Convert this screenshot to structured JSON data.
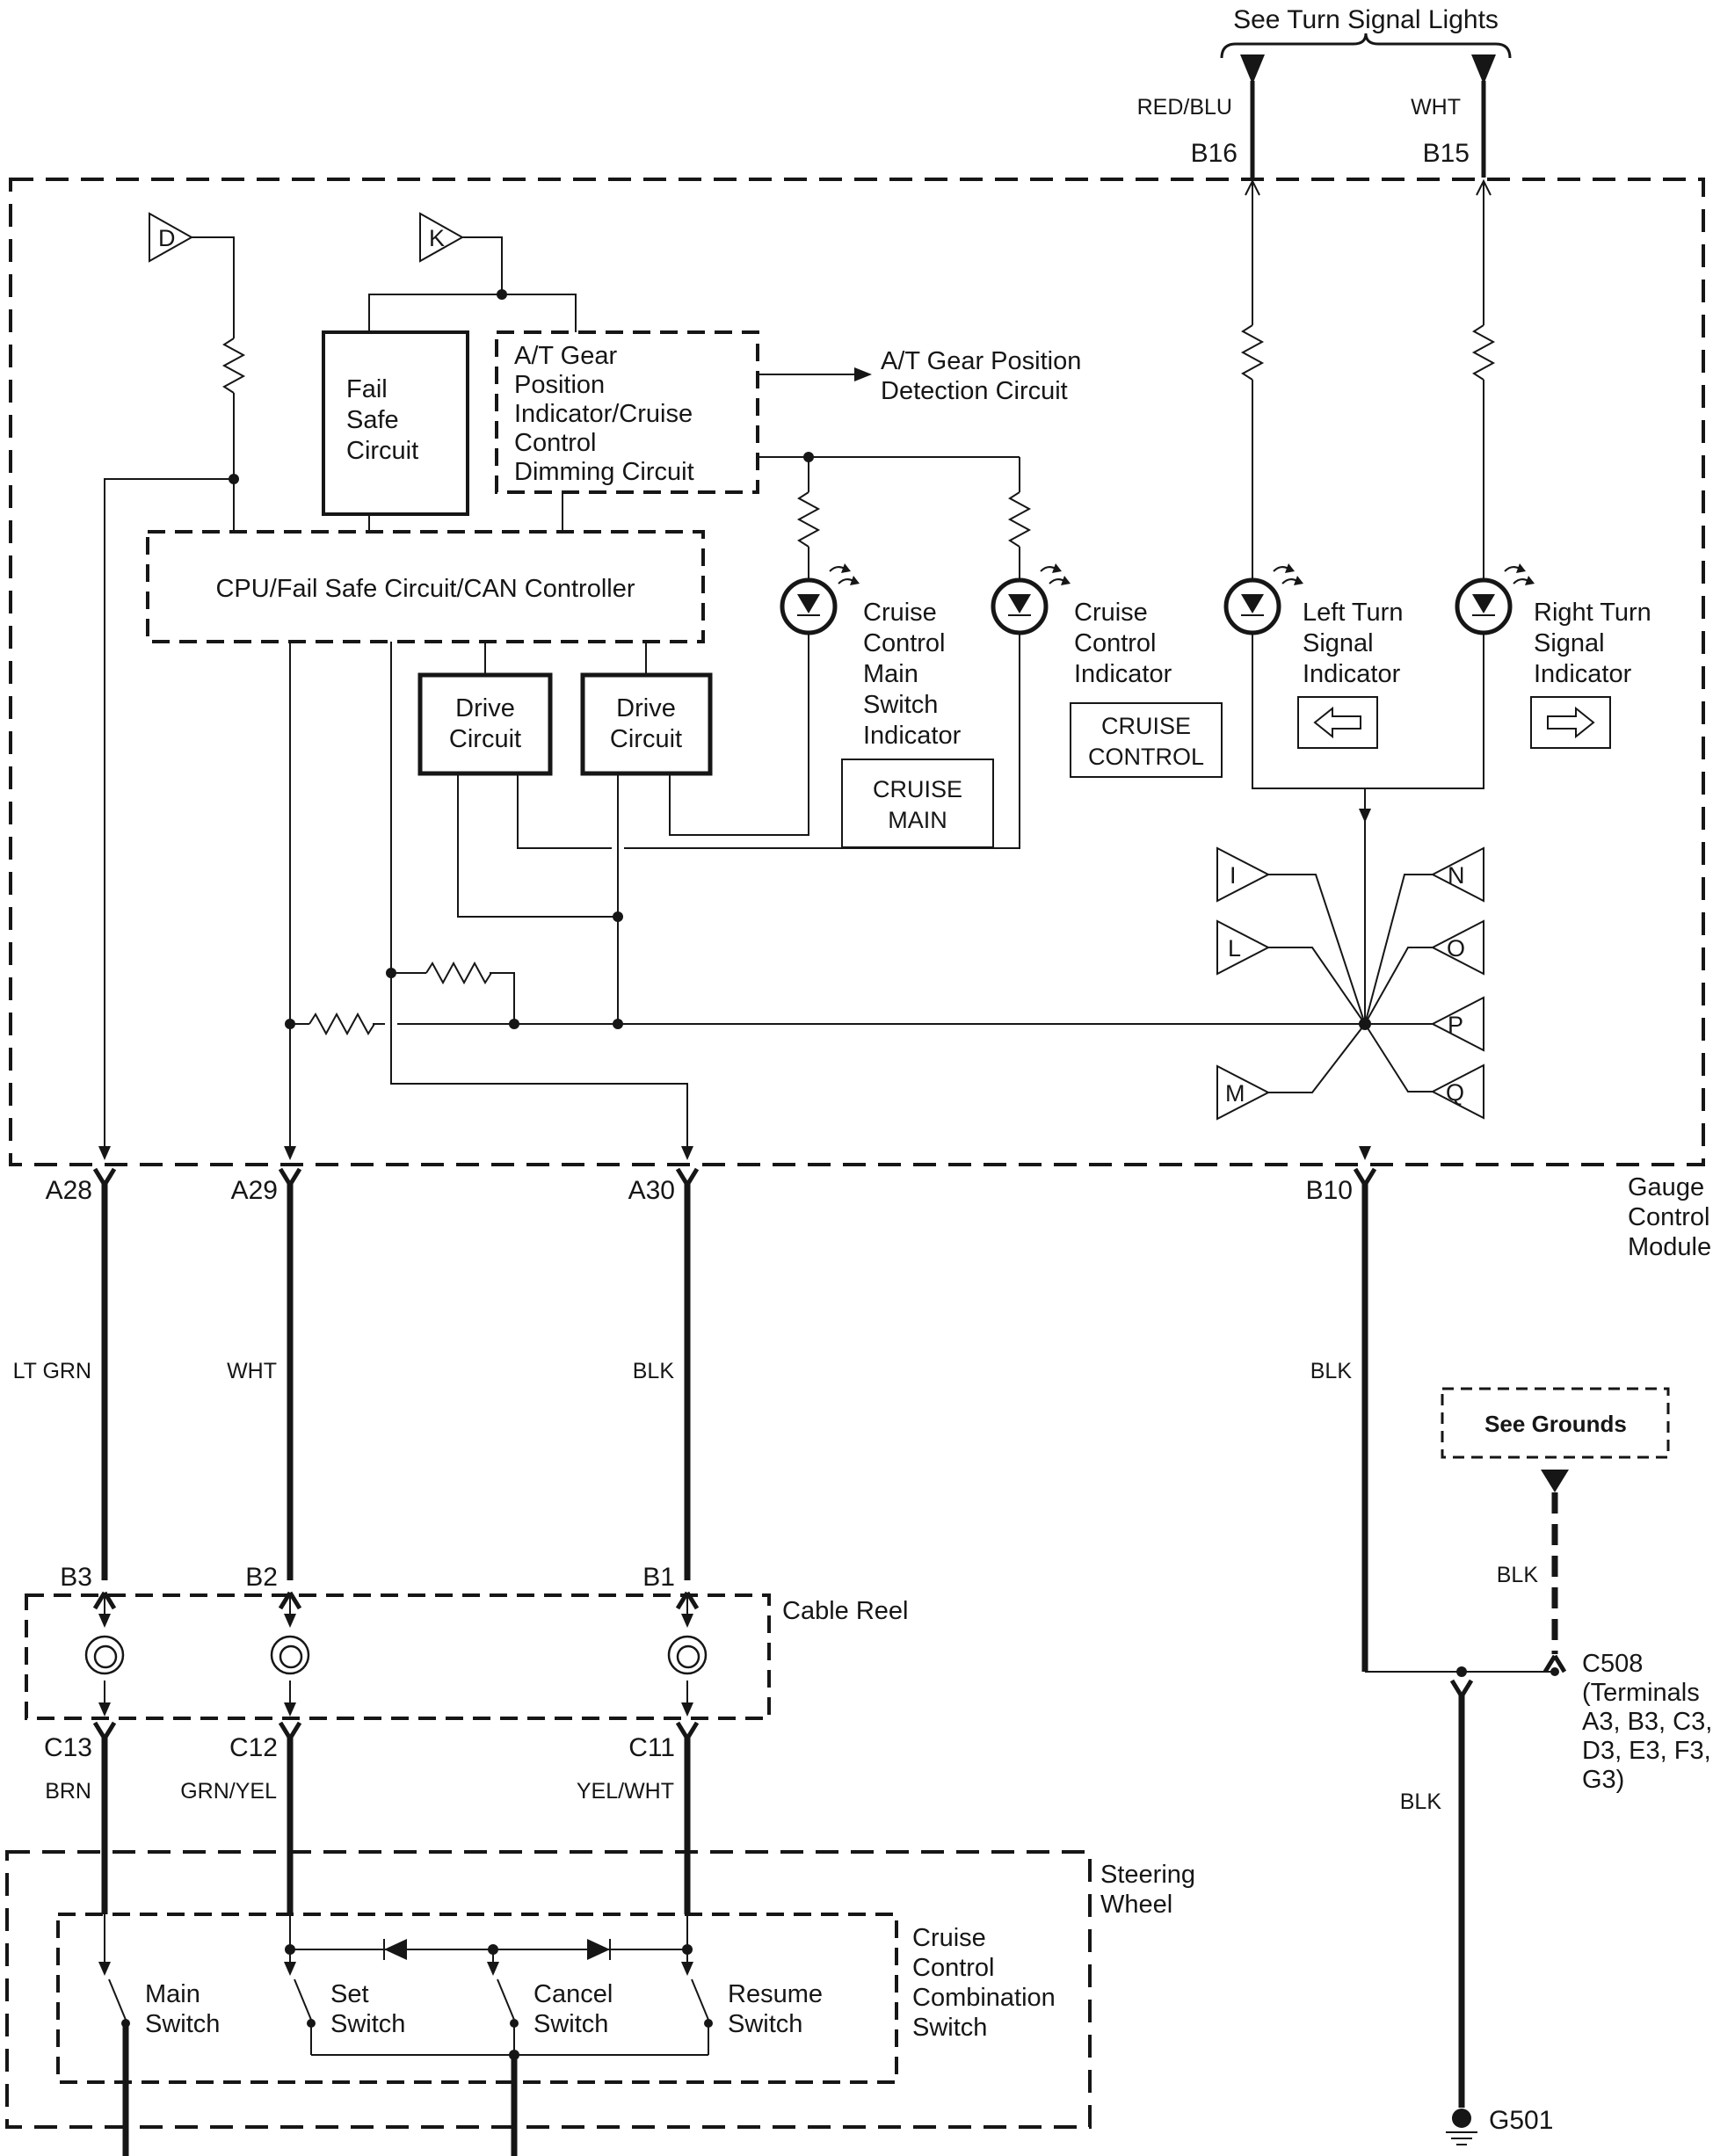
{
  "colors": {
    "ink": "#161616",
    "background": "#ffffff"
  },
  "top": {
    "title": "See Turn Signal Lights",
    "left_wire": {
      "color": "RED/BLU",
      "terminal": "B16"
    },
    "right_wire": {
      "color": "WHT",
      "terminal": "B15"
    }
  },
  "module": {
    "name_lines": [
      "Gauge",
      "Control",
      "Module"
    ],
    "triangle_connectors": {
      "d": "D",
      "k": "K",
      "i": "I",
      "l": "L",
      "m": "M",
      "n": "N",
      "o": "O",
      "p": "P",
      "q": "Q"
    },
    "fail_safe_lines": [
      "Fail",
      "Safe",
      "Circuit"
    ],
    "at_gear_lines": [
      "A/T Gear",
      "Position",
      "Indicator/Cruise",
      "Control",
      "Dimming Circuit"
    ],
    "detection_lines": [
      "A/T Gear Position",
      "Detection Circuit"
    ],
    "cpu_label": "CPU/Fail Safe Circuit/CAN Controller",
    "drive1_lines": [
      "Drive",
      "Circuit"
    ],
    "drive2_lines": [
      "Drive",
      "Circuit"
    ],
    "indicators": {
      "cruise_main": {
        "label_lines": [
          "Cruise",
          "Control",
          "Main",
          "Switch",
          "Indicator"
        ],
        "badge_lines": [
          "CRUISE",
          "MAIN"
        ]
      },
      "cruise_control": {
        "label_lines": [
          "Cruise",
          "Control",
          "Indicator"
        ],
        "badge_lines": [
          "CRUISE",
          "CONTROL"
        ]
      },
      "left_turn": {
        "label_lines": [
          "Left Turn",
          "Signal",
          "Indicator"
        ]
      },
      "right_turn": {
        "label_lines": [
          "Right Turn",
          "Signal",
          "Indicator"
        ]
      }
    },
    "terminals": {
      "a28": "A28",
      "a29": "A29",
      "a30": "A30",
      "b10": "B10"
    }
  },
  "wires": {
    "a28_color": "LT GRN",
    "a29_color": "WHT",
    "a30_color": "BLK",
    "b10_color": "BLK",
    "c13_color": "BRN",
    "c12_color": "GRN/YEL",
    "c11_color": "YEL/WHT",
    "ground_branch_color": "BLK",
    "g501_branch_color": "BLK"
  },
  "cable_reel": {
    "label": "Cable Reel",
    "top_terminals": [
      "B3",
      "B2",
      "B1"
    ],
    "bottom_terminals": [
      "C13",
      "C12",
      "C11"
    ]
  },
  "grounds": {
    "note": "See Grounds",
    "c508_lines": [
      "C508",
      "(Terminals",
      "A3, B3, C3,",
      "D3, E3, F3,",
      "G3)"
    ],
    "ground_id": "G501"
  },
  "steering_wheel": {
    "label_lines": [
      "Steering",
      "Wheel"
    ],
    "combo_label_lines": [
      "Cruise",
      "Control",
      "Combination",
      "Switch"
    ],
    "switches": [
      {
        "label_lines": [
          "Main",
          "Switch"
        ]
      },
      {
        "label_lines": [
          "Set",
          "Switch"
        ]
      },
      {
        "label_lines": [
          "Cancel",
          "Switch"
        ]
      },
      {
        "label_lines": [
          "Resume",
          "Switch"
        ]
      }
    ]
  }
}
